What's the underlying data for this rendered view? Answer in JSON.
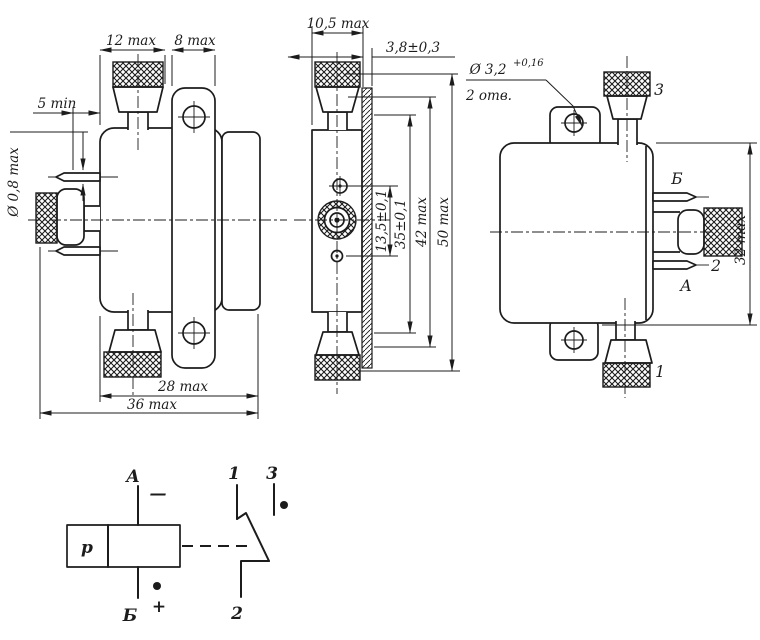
{
  "front": {
    "dim_12": "12 max",
    "dim_8": "8 max",
    "dim_5": "5 min",
    "dim_d08": "Ø 0,8 max",
    "dim_28": "28 max",
    "dim_36": "36 max"
  },
  "side": {
    "dim_105": "10,5 max",
    "dim_38": "3,8±0,3",
    "dim_135": "13,5±0,1",
    "dim_35": "35±0,1",
    "dim_42": "42 max",
    "dim_50": "50 max"
  },
  "back": {
    "dim_32": "32 max",
    "hole_dia": "Ø 3,2",
    "hole_tol": "+0,16",
    "hole_qty": "2 отв.",
    "t1": "1",
    "t2": "2",
    "t3": "3",
    "tA": "А",
    "tB": "Б"
  },
  "schematic": {
    "coil": "р",
    "tA": "А",
    "tB": "Б",
    "t1": "1",
    "t2": "2",
    "t3": "3",
    "minus": "—",
    "plus": "+"
  },
  "colors": {
    "ink": "#1c1c1c",
    "paper": "#ffffff"
  }
}
